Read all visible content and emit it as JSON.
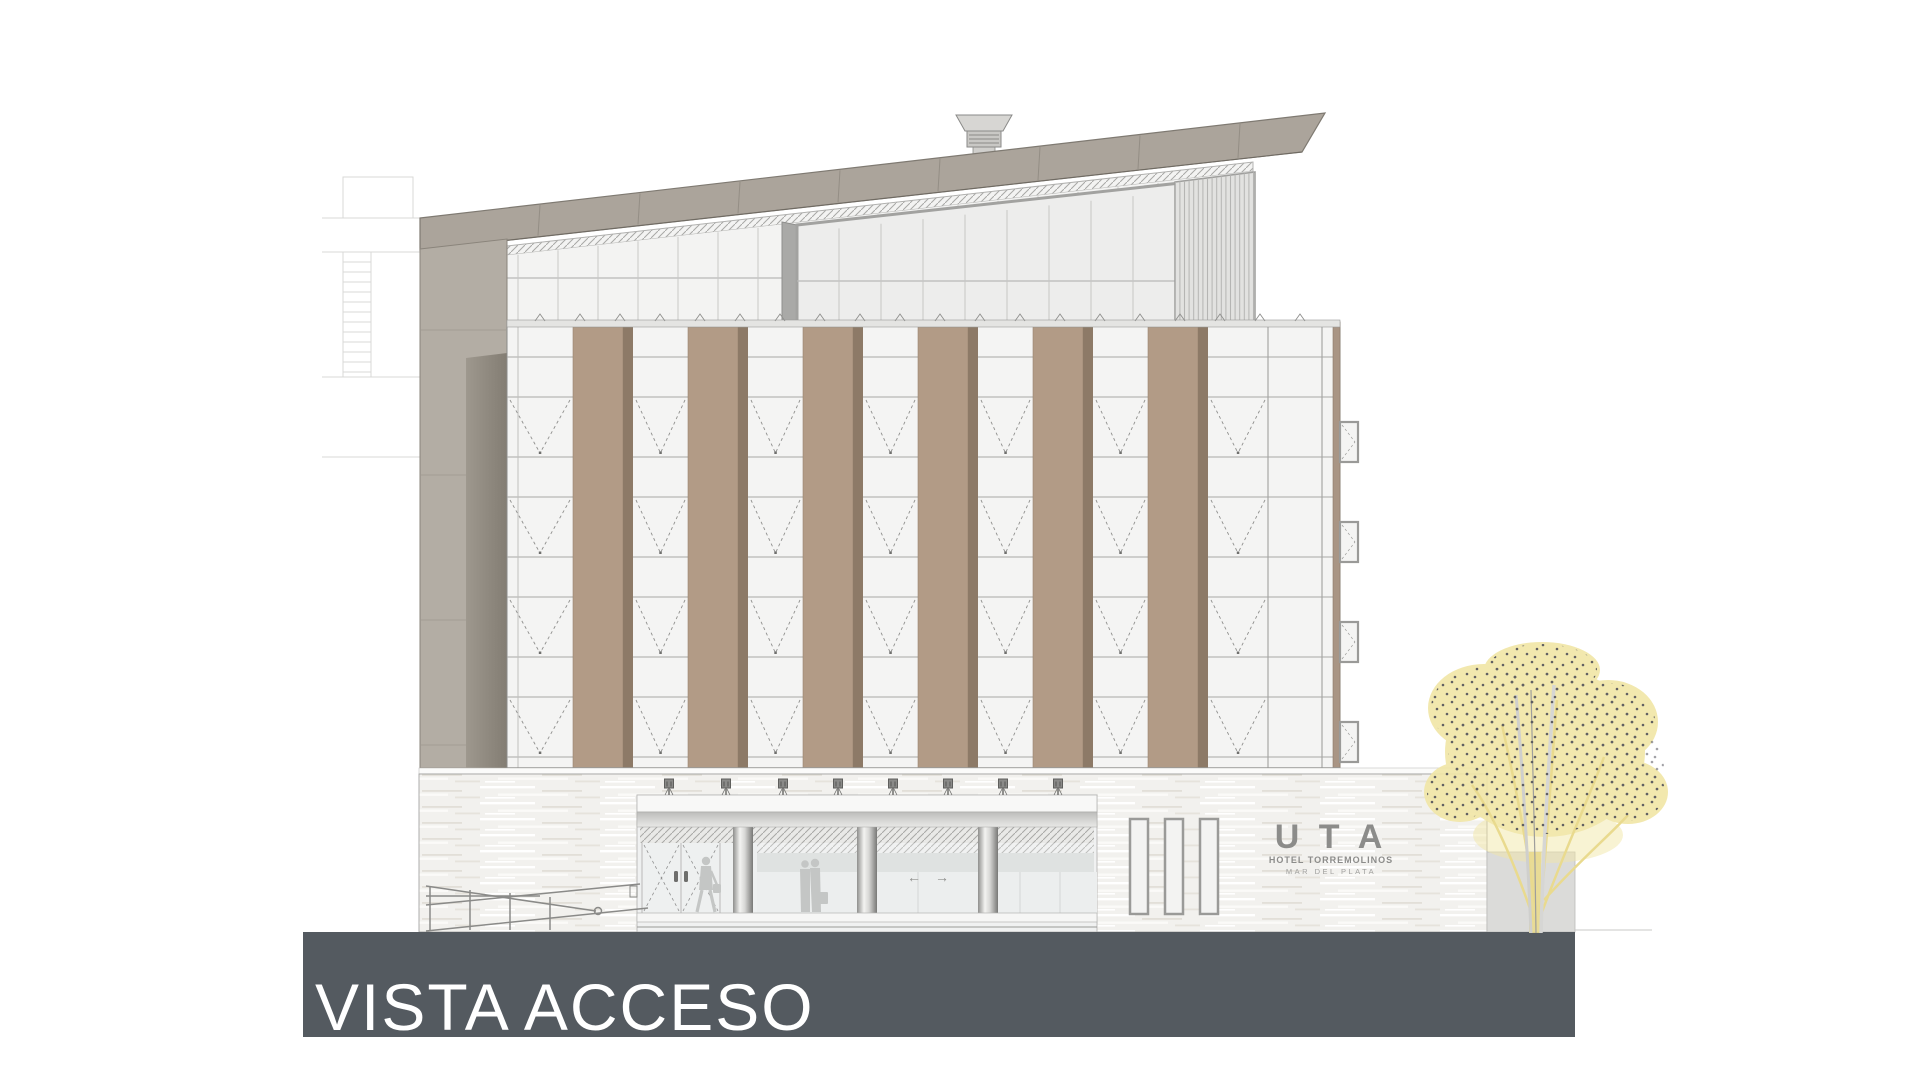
{
  "drawing": {
    "type": "architectural-elevation",
    "title": "VISTA ACCESO"
  },
  "signage": {
    "brand": "U T A",
    "line1": "HOTEL TORREMOLINOS",
    "line2": "MAR DEL PLATA"
  },
  "entrance": {
    "arrow_left": "←",
    "arrow_right": "→"
  },
  "palette": {
    "pillar_brown": "#b29b86",
    "pillar_edge_dark": "#8d7a67",
    "roof_gray": "#aba49b",
    "side_wall_gray": "#b3ada4",
    "facade_white": "#f4f4f3",
    "ground_band_dark": "#545a60",
    "travertine": "#f2f1ee",
    "tree_foliage_yellow": "#f1e6a6",
    "tree_dot_gray": "#52525a",
    "title_text": "#ffffff",
    "sign_gray": "#8c8c8a"
  }
}
